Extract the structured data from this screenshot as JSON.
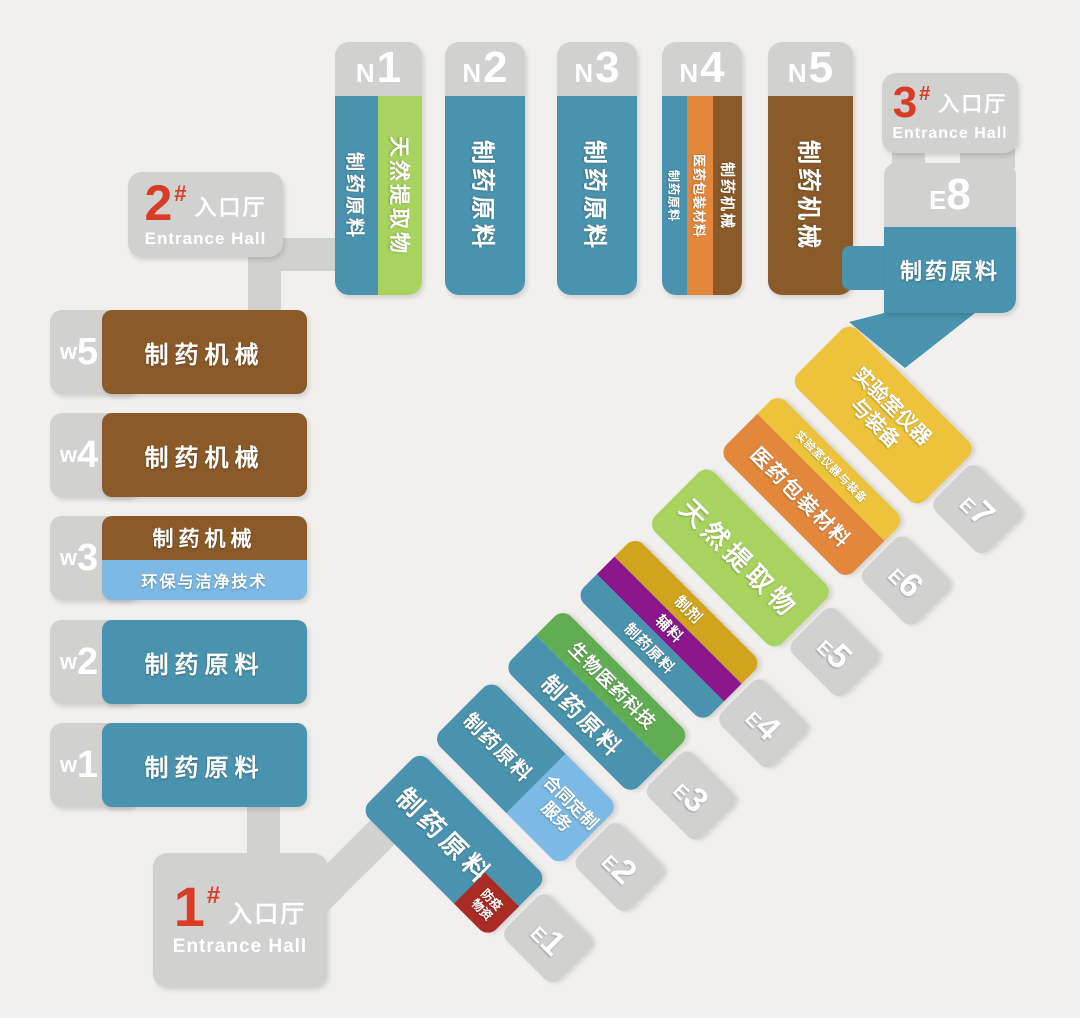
{
  "palette": {
    "teal": "#4a93ae",
    "lime_green": "#a8d35f",
    "brown": "#8a5a28",
    "orange": "#e3873d",
    "yellow": "#edc33c",
    "light_blue": "#7cb9e4",
    "mid_green": "#60ad53",
    "purple": "#8c168c",
    "gold": "#d0a51d",
    "dark_red_tag": "#ab2a23",
    "gray": "#d1d1d0",
    "red_accent": "#d93b25",
    "background": "#f1f0ee",
    "text": "#ffffff"
  },
  "north": [
    {
      "letter": "N",
      "num": "1",
      "strips": [
        {
          "label": "制药原料"
        },
        {
          "label": "天然提取物"
        }
      ]
    },
    {
      "letter": "N",
      "num": "2",
      "strips": [
        {
          "label": "制药原料"
        }
      ]
    },
    {
      "letter": "N",
      "num": "3",
      "strips": [
        {
          "label": "制药原料"
        }
      ]
    },
    {
      "letter": "N",
      "num": "4",
      "strips": [
        {
          "label": "制药原料"
        },
        {
          "label": "医药包装材料"
        },
        {
          "label": "制药机械"
        }
      ]
    },
    {
      "letter": "N",
      "num": "5",
      "strips": [
        {
          "label": "制药机械"
        }
      ]
    }
  ],
  "west": [
    {
      "letter": "w",
      "num": "5",
      "rows": [
        {
          "label": "制药机械"
        }
      ]
    },
    {
      "letter": "w",
      "num": "4",
      "rows": [
        {
          "label": "制药机械"
        }
      ]
    },
    {
      "letter": "w",
      "num": "3",
      "rows": [
        {
          "label": "制药机械"
        },
        {
          "label": "环保与洁净技术"
        }
      ]
    },
    {
      "letter": "w",
      "num": "2",
      "rows": [
        {
          "label": "制药原料"
        }
      ]
    },
    {
      "letter": "w",
      "num": "1",
      "rows": [
        {
          "label": "制药原料"
        }
      ]
    }
  ],
  "east": [
    {
      "letter": "E",
      "num": "1",
      "strips": [
        {
          "label": "制药原料"
        }
      ],
      "tag": {
        "line1": "防疫",
        "line2": "物资"
      }
    },
    {
      "letter": "E",
      "num": "2",
      "top_segment": "制药原料",
      "bottom_segment": {
        "line1": "合同定制",
        "line2": "服务"
      }
    },
    {
      "letter": "E",
      "num": "3",
      "strips": [
        {
          "label": "制药原料"
        },
        {
          "label": "生物医药科技"
        }
      ]
    },
    {
      "letter": "E",
      "num": "4",
      "strips": [
        {
          "label": "制药原料"
        },
        {
          "label": "辅料"
        },
        {
          "label": "制剂"
        }
      ]
    },
    {
      "letter": "E",
      "num": "5",
      "strips": [
        {
          "label": "天然提取物"
        }
      ]
    },
    {
      "letter": "E",
      "num": "6",
      "strips": [
        {
          "label": "医药包装材料"
        },
        {
          "label": "实验室仪器与装备"
        }
      ]
    },
    {
      "letter": "E",
      "num": "7",
      "label_line1": "实验室仪器",
      "label_line2": "与装备"
    }
  ],
  "e8": {
    "letter": "E",
    "num": "8",
    "label": "制药原料"
  },
  "entrances": [
    {
      "number": "1",
      "hash": "#",
      "cn": "入口厅",
      "en": "Entrance Hall"
    },
    {
      "number": "2",
      "hash": "#",
      "cn": "入口厅",
      "en": "Entrance Hall"
    },
    {
      "number": "3",
      "hash": "#",
      "cn": "入口厅",
      "en": "Entrance Hall"
    }
  ]
}
